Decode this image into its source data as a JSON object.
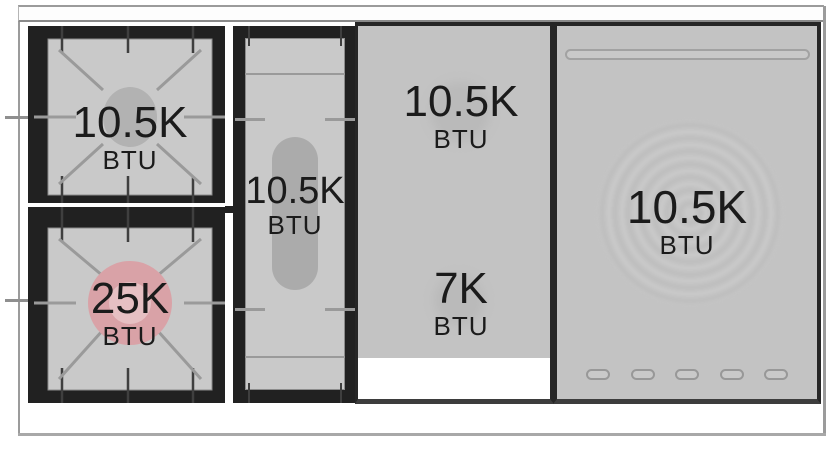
{
  "zones": {
    "left_rear_burner": {
      "value": "10.5K",
      "unit": "BTU"
    },
    "left_front_burner": {
      "value": "25K",
      "unit": "BTU"
    },
    "griddle_burner": {
      "value": "10.5K",
      "unit": "BTU"
    },
    "center_rear_zone": {
      "value": "10.5K",
      "unit": "BTU"
    },
    "center_front_zone": {
      "value": "7K",
      "unit": "BTU"
    },
    "right_zone": {
      "value": "10.5K",
      "unit": "BTU"
    }
  },
  "colors": {
    "frame_black": "#212121",
    "panel_gray": "#c9c9c9",
    "surface_gray": "#c3c3c3",
    "highlight_burner_fill": "#d9a2a7",
    "highlight_burner_inner": "#e6c0c3",
    "burner_cap_gray": "#b2b2b2"
  }
}
